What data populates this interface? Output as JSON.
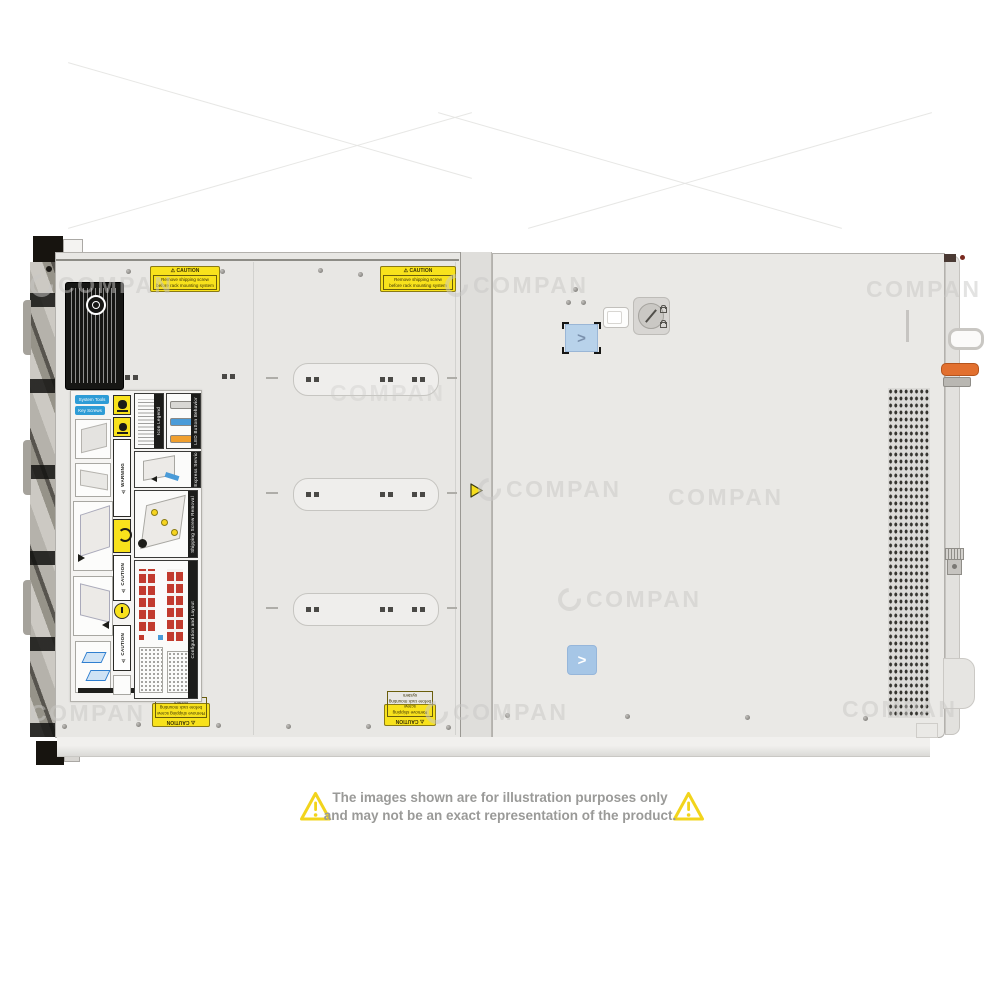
{
  "watermark": {
    "text": "COMPAN"
  },
  "disclaimer": {
    "line1": "The images shown are for illustration purposes only",
    "line2": "and may not be an exact representation of the product."
  },
  "caution": {
    "header": "⚠ CAUTION",
    "line1": "Remove shipping screw",
    "line2": "before rack mounting system"
  },
  "label": {
    "chip1": "System Tools",
    "chip2": "Key Screws",
    "warning": "⚠ WARNING",
    "caution1": "⚠ CAUTION",
    "caution2": "⚠ CAUTION",
    "icon_legend": "Icon Legend",
    "led": "LED Button Behavior",
    "service_tag": "Rear Express Service Tag",
    "shipping": "Shipping Screw Removal",
    "config": "Configuration and Layout"
  },
  "colors": {
    "caution_yellow": "#f8e21c",
    "triangle_yellow": "#f2d41c",
    "release_button_blue": "#a6c6e6",
    "lever_orange": "#e2702f",
    "drive_grid_red": "#c23b2e",
    "led_blue": "#4a9bd8",
    "led_orange": "#f09f2e"
  }
}
